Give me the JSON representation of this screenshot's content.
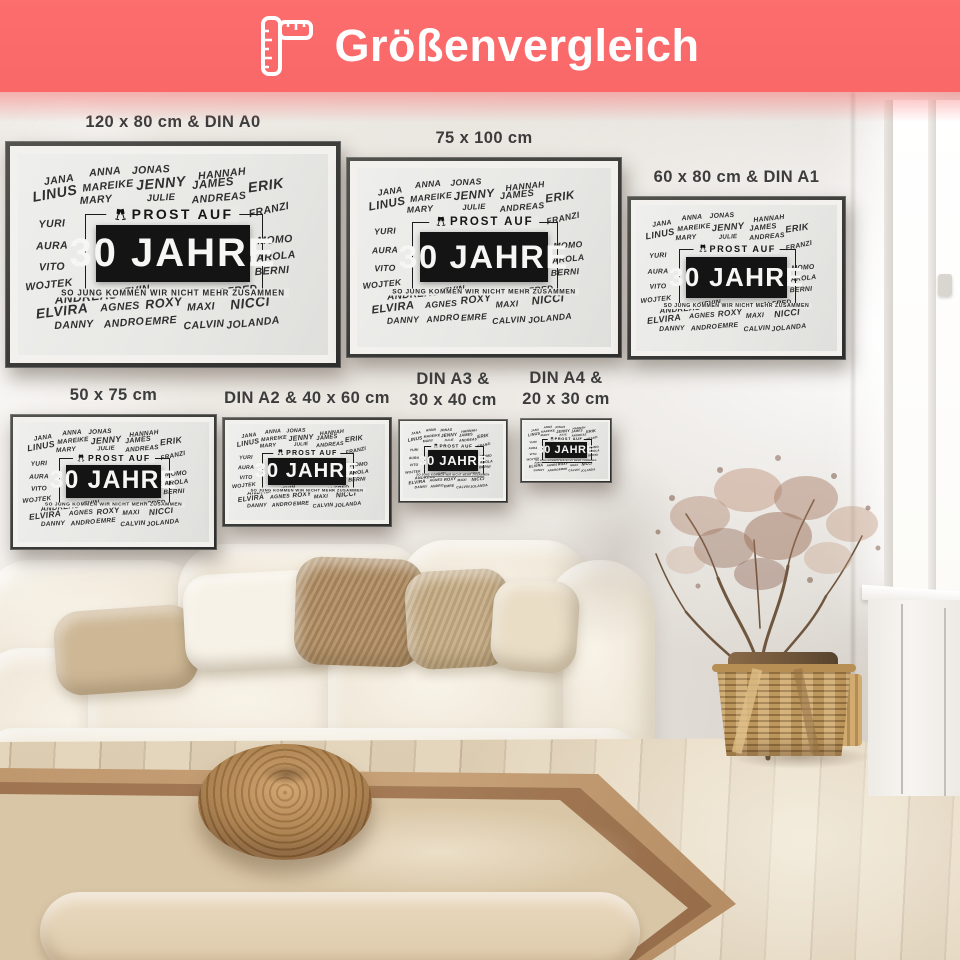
{
  "header": {
    "title": "Größenvergleich",
    "background_color": "#FB6A6A",
    "text_color": "#FFFFFF",
    "icon": "ruler-icon"
  },
  "poster_design": {
    "icon": "champagne-glasses-icon",
    "top_label": "PROST AUF",
    "main_title": "30 JAHRE",
    "subtitle": "SO JUNG KOMMEN WIR NICHT MEHR ZUSAMMEN",
    "colors": {
      "frame": "#3A3A38",
      "mat": "#F2F1EE",
      "print_background": "#E9E9E6",
      "title_box": "#141414",
      "title_text": "#F6F6F4"
    },
    "names": [
      {
        "text": "JANA",
        "x": 13,
        "y": 13,
        "s": 1,
        "r": -8
      },
      {
        "text": "ANNA",
        "x": 28,
        "y": 9,
        "s": 1,
        "r": -5
      },
      {
        "text": "JONAS",
        "x": 43,
        "y": 8,
        "s": 1,
        "r": -3
      },
      {
        "text": "HANNAH",
        "x": 66,
        "y": 10,
        "s": 1,
        "r": -6
      },
      {
        "text": "LINUS",
        "x": 12,
        "y": 20,
        "s": 1.35,
        "r": -10
      },
      {
        "text": "MAREIKE",
        "x": 29,
        "y": 16,
        "s": 1,
        "r": -6
      },
      {
        "text": "JENNY",
        "x": 46,
        "y": 15,
        "s": 1.35,
        "r": -5
      },
      {
        "text": "JAMES",
        "x": 63,
        "y": 15,
        "s": 1.1,
        "r": -6
      },
      {
        "text": "ERIK",
        "x": 80,
        "y": 16,
        "s": 1.35,
        "r": -8
      },
      {
        "text": "MARY",
        "x": 25,
        "y": 23,
        "s": 1,
        "r": -4
      },
      {
        "text": "JULIE",
        "x": 46,
        "y": 22,
        "s": 0.9,
        "r": -3
      },
      {
        "text": "ANDREAS",
        "x": 65,
        "y": 22,
        "s": 1,
        "r": -5
      },
      {
        "text": "FRANZI",
        "x": 81,
        "y": 28,
        "s": 1,
        "r": -12
      },
      {
        "text": "YURI",
        "x": 11,
        "y": 35,
        "s": 1,
        "r": -3
      },
      {
        "text": "MOMO",
        "x": 83,
        "y": 43,
        "s": 1,
        "r": -4
      },
      {
        "text": "AURA",
        "x": 11,
        "y": 46,
        "s": 1,
        "r": -2
      },
      {
        "text": "CAROLA",
        "x": 82,
        "y": 51,
        "s": 1,
        "r": -6
      },
      {
        "text": "VITO",
        "x": 11,
        "y": 56,
        "s": 1,
        "r": -2
      },
      {
        "text": "BERNI",
        "x": 82,
        "y": 58,
        "s": 1,
        "r": -4
      },
      {
        "text": "WOJTEK",
        "x": 10,
        "y": 65,
        "s": 1,
        "r": -6
      },
      {
        "text": "ANDREAS",
        "x": 22,
        "y": 71,
        "s": 1.15,
        "r": -5
      },
      {
        "text": "KEVIN",
        "x": 37,
        "y": 68,
        "s": 1,
        "r": -8
      },
      {
        "text": "ALFRED",
        "x": 70,
        "y": 68,
        "s": 1,
        "r": -6
      },
      {
        "text": "ELVIRA",
        "x": 14,
        "y": 78,
        "s": 1.3,
        "r": -7
      },
      {
        "text": "AGNES",
        "x": 33,
        "y": 76,
        "s": 1,
        "r": -4
      },
      {
        "text": "ROXY",
        "x": 47,
        "y": 74,
        "s": 1.2,
        "r": -6
      },
      {
        "text": "MAXI",
        "x": 59,
        "y": 76,
        "s": 1,
        "r": -3
      },
      {
        "text": "NICCI",
        "x": 75,
        "y": 74,
        "s": 1.3,
        "r": -6
      },
      {
        "text": "DANNY",
        "x": 18,
        "y": 85,
        "s": 1,
        "r": -3
      },
      {
        "text": "ANDRO",
        "x": 34,
        "y": 84,
        "s": 1,
        "r": -5
      },
      {
        "text": "EMRE",
        "x": 46,
        "y": 83,
        "s": 1,
        "r": -4
      },
      {
        "text": "CALVIN",
        "x": 60,
        "y": 85,
        "s": 1,
        "r": -4
      },
      {
        "text": "JOLANDA",
        "x": 76,
        "y": 84,
        "s": 1,
        "r": -6
      }
    ]
  },
  "posters": [
    {
      "id": "120x80-din-a0",
      "label_lines": [
        "120 x 80 cm & DIN A0"
      ],
      "x": 5,
      "y": 49,
      "w": 336,
      "h": 227
    },
    {
      "id": "75x100",
      "label_lines": [
        "75 x 100 cm"
      ],
      "x": 346,
      "y": 65,
      "w": 276,
      "h": 201
    },
    {
      "id": "60x80-din-a1",
      "label_lines": [
        "60 x 80 cm & DIN A1"
      ],
      "x": 627,
      "y": 104,
      "w": 219,
      "h": 164
    },
    {
      "id": "50x75",
      "label_lines": [
        "50 x 75 cm"
      ],
      "x": 10,
      "y": 322,
      "w": 207,
      "h": 136
    },
    {
      "id": "din-a2-40x60",
      "label_lines": [
        "DIN A2 & 40 x 60 cm"
      ],
      "x": 222,
      "y": 325,
      "w": 170,
      "h": 110
    },
    {
      "id": "din-a3-30x40",
      "label_lines": [
        "DIN A3 &",
        "30 x 40 cm"
      ],
      "x": 398,
      "y": 327,
      "w": 110,
      "h": 84
    },
    {
      "id": "din-a4-20x30",
      "label_lines": [
        "DIN A4 &",
        "20 x 30 cm"
      ],
      "x": 520,
      "y": 326,
      "w": 92,
      "h": 65
    }
  ]
}
